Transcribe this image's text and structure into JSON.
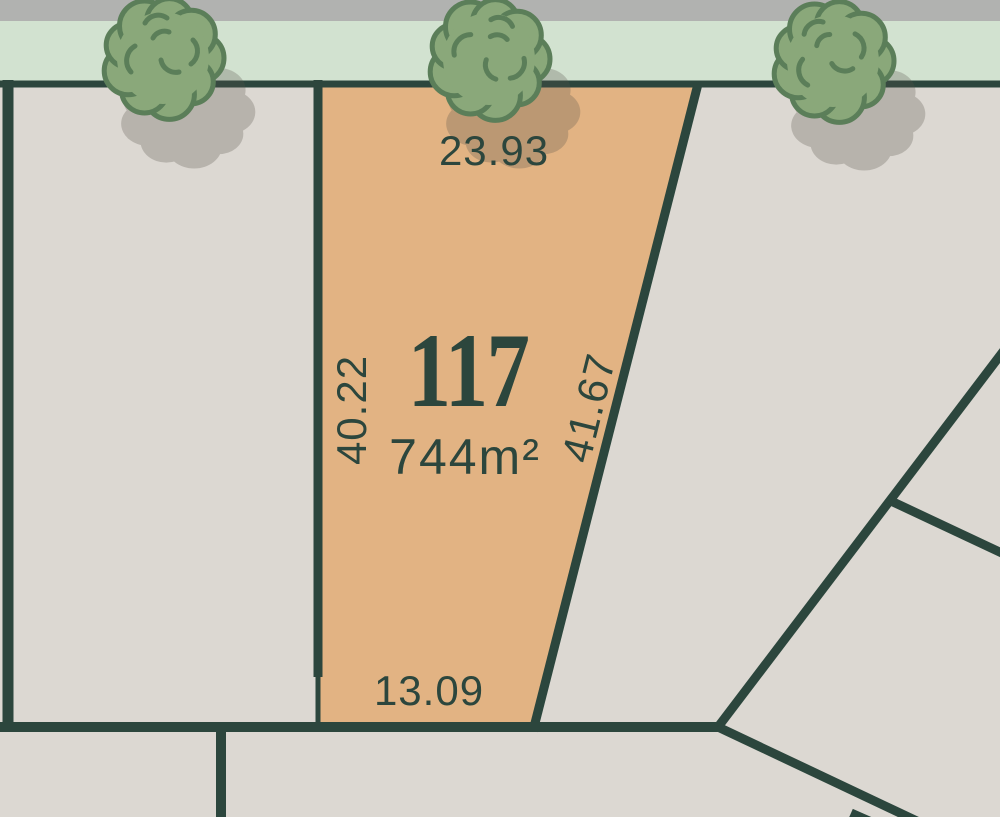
{
  "highlighted_lot": {
    "number": "117",
    "area": "744m²",
    "dimensions": {
      "top": "23.93",
      "left": "40.22",
      "right": "41.67",
      "bottom": "13.09"
    }
  },
  "scene": {
    "type": "subdivision-lot-map",
    "trees_count": 3,
    "icons": {
      "tree": "scalloped-foliage-blob",
      "tree_shadow": "offset-gray-foliage-blob"
    }
  },
  "colors": {
    "boundary_line": "#2c463d",
    "label_text": "#2c463d",
    "highlighted_lot_fill": "#e2b383",
    "adjacent_lot_fill": "#dcd8d2",
    "road_strip": "#b1b2b0",
    "verge_strip": "#d2e2d0",
    "tree_fill": "#8aa87a",
    "tree_outline": "#5b7e59",
    "shadow": "#57534a"
  }
}
